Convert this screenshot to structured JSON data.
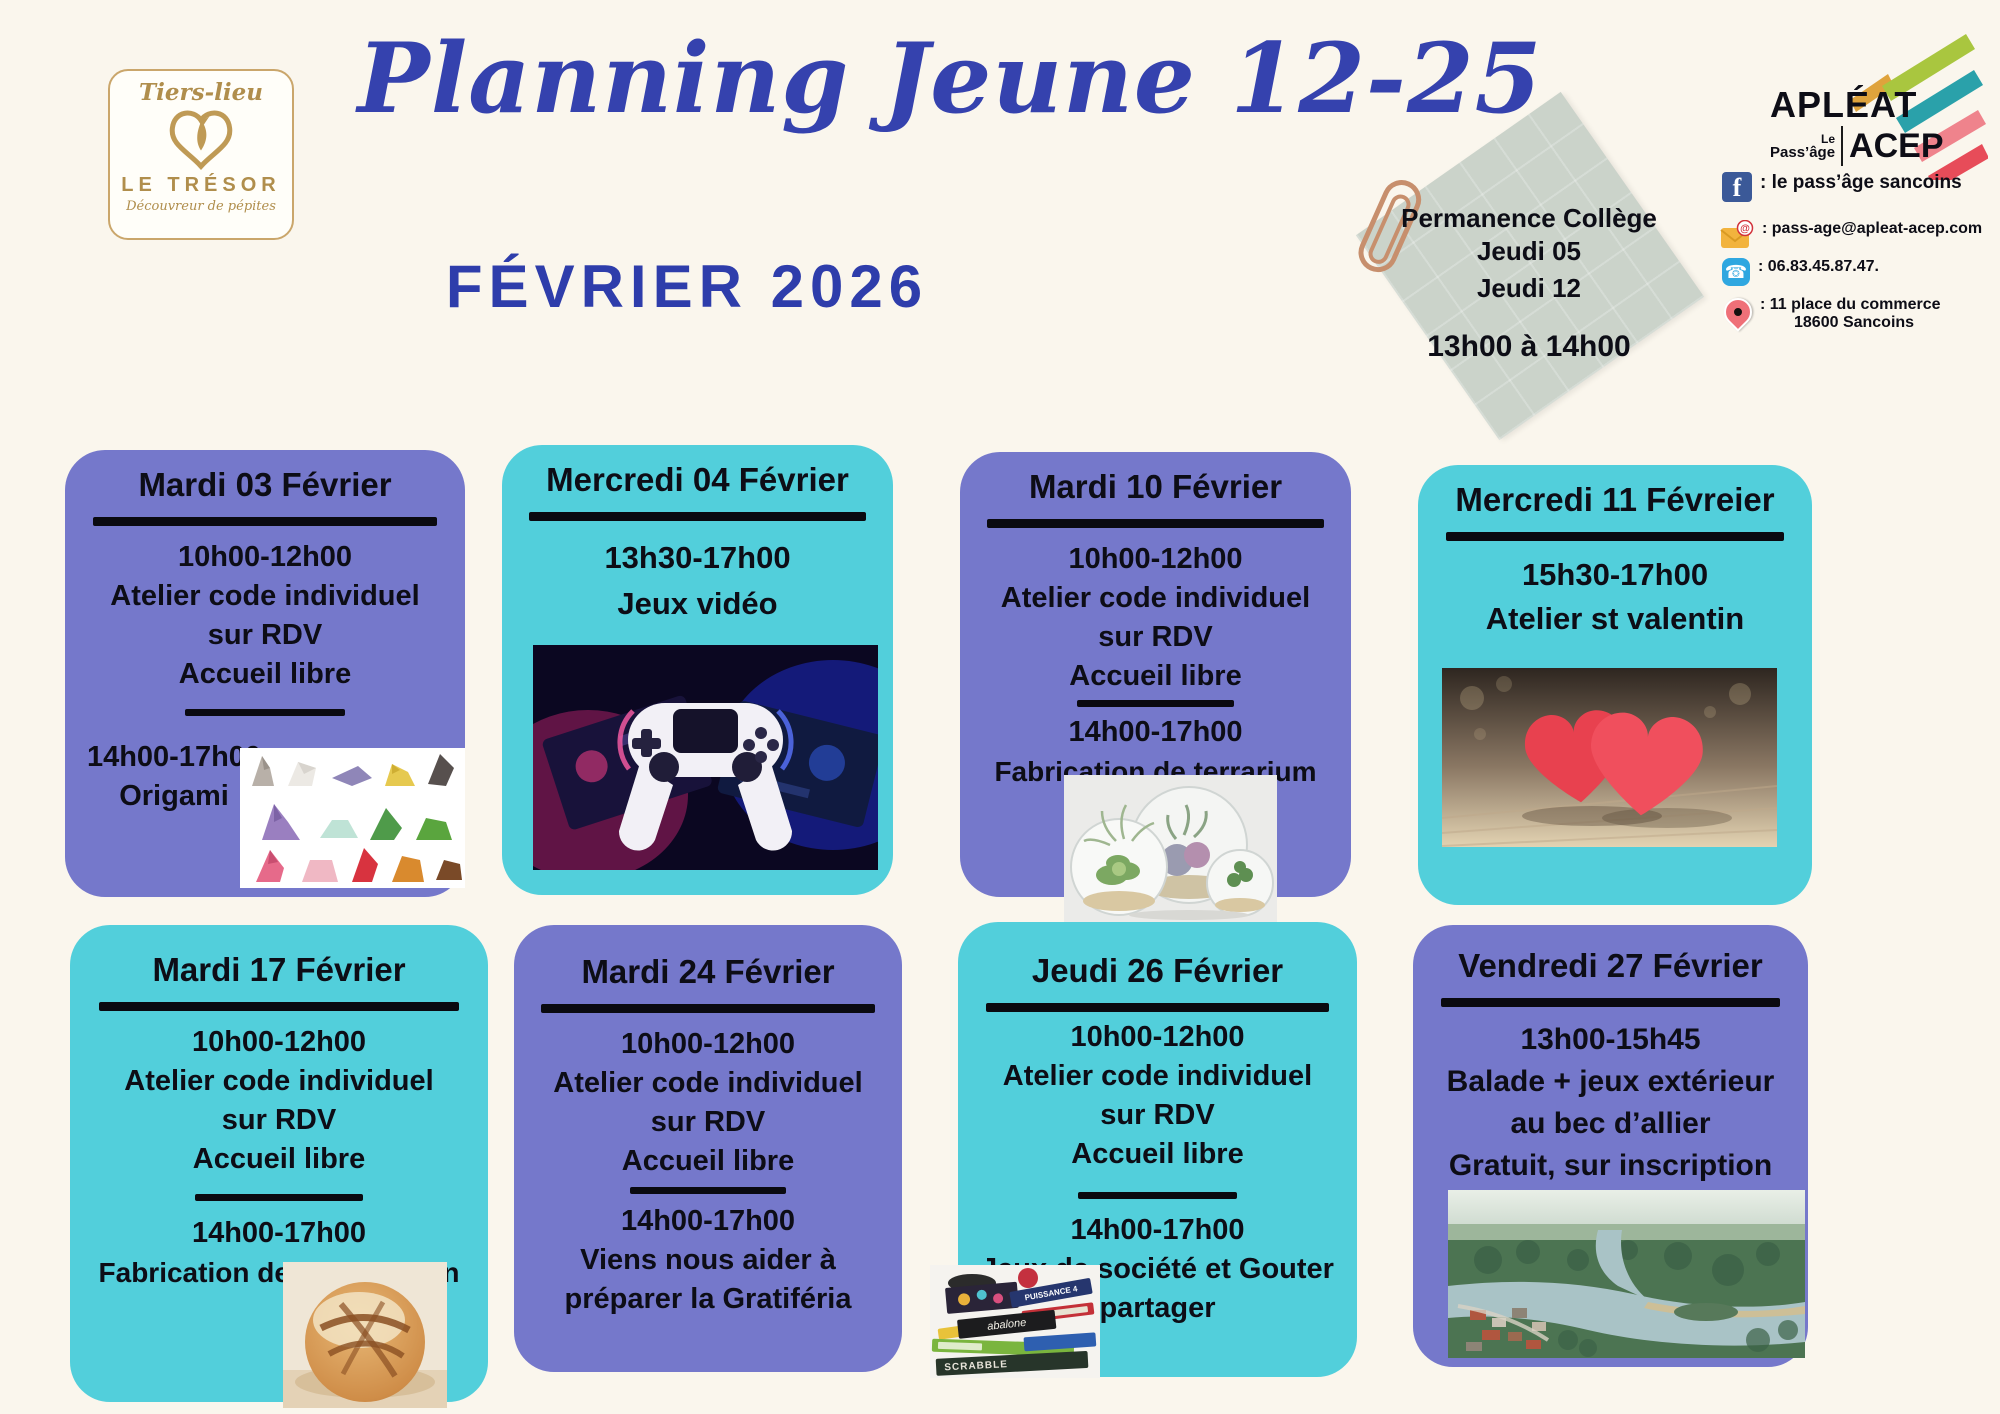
{
  "branding": {
    "tiers_lieu": "Tiers-lieu",
    "name": "LE TRÉSOR",
    "tagline": "Découvreur de pépites"
  },
  "header": {
    "title": "Planning Jeune 12-25",
    "subtitle": "FÉVRIER 2026"
  },
  "note": {
    "line1": "Permanence Collège",
    "line2": "Jeudi 05",
    "line3": "Jeudi 12",
    "time": "13h00 à 14h00"
  },
  "org": {
    "name_apleat": "APLÉAT",
    "small_le": "Le",
    "small_passage": "Pass’âge",
    "name_acep": "ACEP",
    "facebook_icon_letter": "f",
    "phone_icon_glyph": "☎",
    "contacts": {
      "facebook": ": le pass’âge sancoins",
      "email": ": pass-age@apleat-acep.com",
      "phone": ": 06.83.45.87.47.",
      "address_line1": ": 11 place du commerce",
      "address_line2": "18600 Sancoins"
    }
  },
  "colors": {
    "background": "#FAF6ED",
    "purple_card": "#7578CB",
    "teal_card": "#52CFDB",
    "title_blue": "#3542AE",
    "subtitle_blue": "#2E3DAB",
    "note_bg": "#CBD3CA",
    "text_black": "#0D0D16"
  },
  "cards": [
    {
      "title": "Mardi 03 Février",
      "color": "purple",
      "s1": [
        "10h00-12h00",
        "Atelier code individuel",
        "sur RDV",
        "Accueil libre"
      ],
      "s2": [
        "14h00-17h00",
        "Origami"
      ],
      "image": "origami-photo"
    },
    {
      "title": "Mercredi 04 Février",
      "color": "teal",
      "s1": [
        "13h30-17h00",
        "Jeux vidéo"
      ],
      "s2": [],
      "image": "game-controller-photo"
    },
    {
      "title": "Mardi 10 Février",
      "color": "purple",
      "s1": [
        "10h00-12h00",
        "Atelier code individuel",
        "sur RDV",
        "Accueil libre"
      ],
      "s2": [
        "14h00-17h00",
        "Fabrication de terrarium"
      ],
      "image": "terrarium-photo"
    },
    {
      "title": "Mercredi 11 Févreier",
      "color": "teal",
      "s1": [
        "15h30-17h00",
        "Atelier st valentin"
      ],
      "s2": [],
      "image": "hearts-photo"
    },
    {
      "title": "Mardi 17 Février",
      "color": "teal",
      "s1": [
        "10h00-12h00",
        "Atelier code individuel",
        "sur RDV",
        "Accueil libre"
      ],
      "s2": [
        "14h00-17h00",
        "Fabrication de pain Maison"
      ],
      "image": "bread-photo"
    },
    {
      "title": "Mardi 24 Février",
      "color": "purple",
      "s1": [
        "10h00-12h00",
        "Atelier code individuel",
        "sur RDV",
        "Accueil libre"
      ],
      "s2": [
        "14h00-17h00",
        "Viens nous aider à",
        "préparer la Gratiféria"
      ],
      "image": null
    },
    {
      "title": "Jeudi 26 Février",
      "color": "teal",
      "s1": [
        "10h00-12h00",
        "Atelier code individuel",
        "sur RDV",
        "Accueil libre"
      ],
      "s2": [
        "14h00-17h00",
        "Jeux de société et Gouter",
        "partager"
      ],
      "image": "board-games-photo"
    },
    {
      "title": "Vendredi 27 Février",
      "color": "purple",
      "s1": [
        "13h00-15h45",
        "Balade + jeux extérieur",
        "au bec d’allier",
        "Gratuit, sur inscription"
      ],
      "s2": [],
      "image": "river-photo"
    }
  ],
  "images": {
    "board_game_labels": [
      "abalone",
      "SCRABBLE",
      "PUISSANCE 4"
    ]
  }
}
